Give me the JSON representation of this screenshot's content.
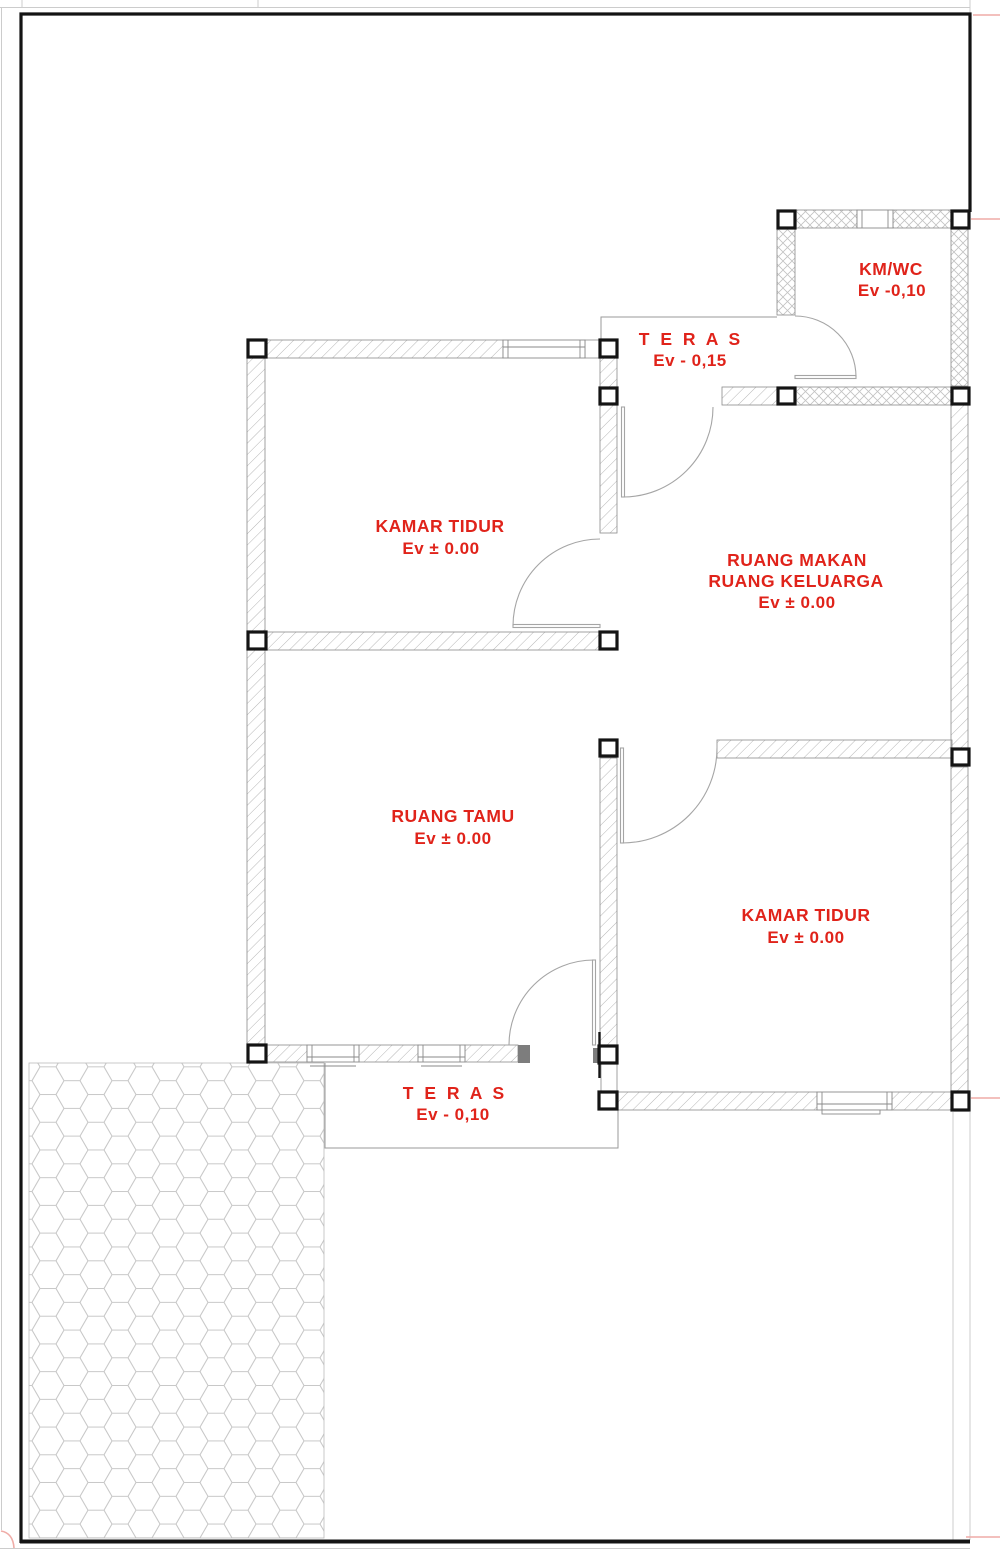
{
  "drawing_colors": {
    "label_red": "#e0231a",
    "reference_line_pink": "#efaca7",
    "wall_hatch_gray": "#b6b6b6",
    "boundary_black": "#141414"
  },
  "rooms": {
    "kmwc": {
      "name": "KM/WC",
      "elevation": "Ev -0,10"
    },
    "teras_atas": {
      "name": "T E R A S",
      "elevation": "Ev - 0,15"
    },
    "kamar_tidur_1": {
      "name": "KAMAR TIDUR",
      "elevation": "Ev ± 0.00"
    },
    "ruang_makan": {
      "name_line1": "RUANG MAKAN",
      "name_line2": "RUANG KELUARGA",
      "elevation": "Ev  ± 0.00"
    },
    "ruang_tamu": {
      "name": "RUANG TAMU",
      "elevation": "Ev  ± 0.00"
    },
    "kamar_tidur_2": {
      "name": "KAMAR TIDUR",
      "elevation": "Ev  ± 0.00"
    },
    "teras_bawah": {
      "name": "T E R A S",
      "elevation": "Ev - 0,10"
    }
  }
}
